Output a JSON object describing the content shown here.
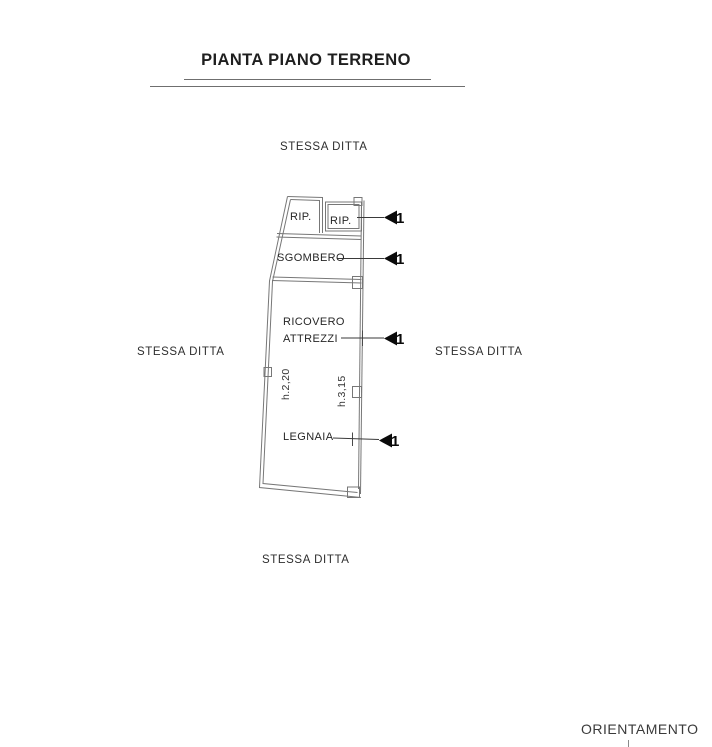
{
  "title": "PIANTA PIANO TERRENO",
  "neighbors": {
    "top": "STESSA DITTA",
    "left": "STESSA DITTA",
    "right": "STESSA DITTA",
    "bottom": "STESSA DITTA"
  },
  "orientation": {
    "label": "ORIENTAMENTO"
  },
  "plan": {
    "rooms": {
      "rip_left": {
        "label": "RIP."
      },
      "rip_right": {
        "label": "RIP."
      },
      "sgombero": {
        "label": "SGOMBERO"
      },
      "ricovero_attrezzi": {
        "line1": "RICOVERO",
        "line2": "ATTREZZI"
      },
      "legnaia": {
        "label": "LEGNAIA"
      }
    },
    "heights": {
      "left": "h.2,20",
      "right": "h.3,15"
    },
    "access_markers": {
      "m1": "1",
      "m2": "1",
      "m3": "1",
      "m4": "1"
    }
  },
  "colors": {
    "background": "#ffffff",
    "ink": "#2b2b2b",
    "wall": "#777777",
    "leader": "#3a3a3a",
    "marker": "#0a0a0a"
  }
}
